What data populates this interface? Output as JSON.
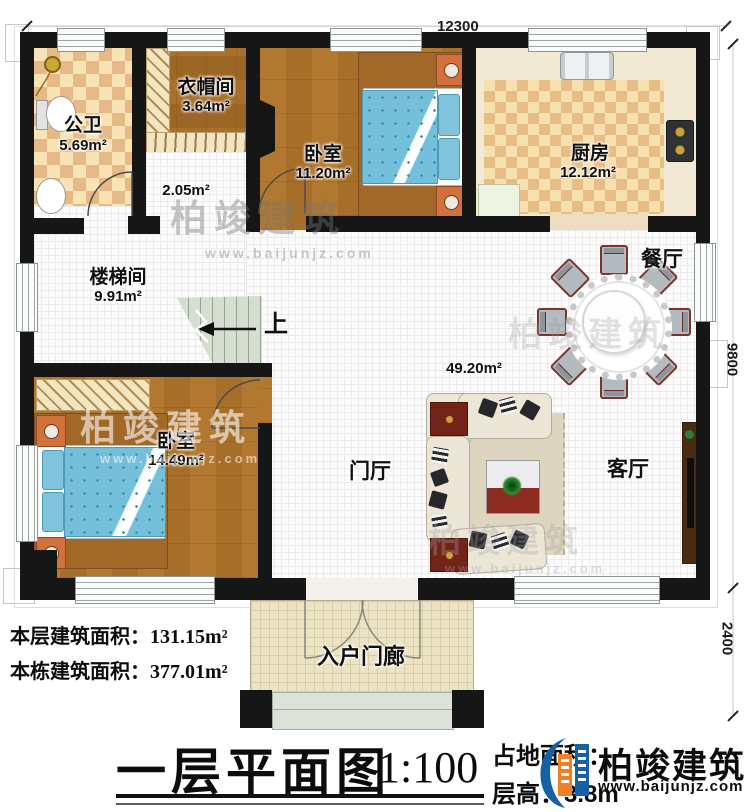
{
  "plan": {
    "dim_top": "12300",
    "dim_right": "9800",
    "dim_right_lower": "2400",
    "stairs_up": "上"
  },
  "rooms": {
    "toilet": {
      "name": "公卫",
      "area": "5.69m²"
    },
    "cloak": {
      "name": "衣帽间",
      "area": "3.64m²"
    },
    "bedroom1": {
      "name": "卧室",
      "area": "11.20m²"
    },
    "kitchen": {
      "name": "厨房",
      "area": "12.12m²"
    },
    "hallway": {
      "area": "2.05m²"
    },
    "stairhall": {
      "name": "楼梯间",
      "area": "9.91m²"
    },
    "bedroom2": {
      "name": "卧室",
      "area": "14.49m²"
    },
    "foyer": {
      "name": "门厅"
    },
    "dining": {
      "name": "餐厅"
    },
    "living": {
      "name": "客厅"
    },
    "great_room": {
      "area": "49.20m²"
    },
    "porch": {
      "name": "入户门廊"
    }
  },
  "footer": {
    "floor_area_label": "本层建筑面积：",
    "floor_area_value": "131.15m²",
    "building_area_label": "本栋建筑面积：",
    "building_area_value": "377.01m²",
    "title": "一层平面图",
    "scale": "1:100",
    "land_area_label": "占地面积：",
    "storey_height_label": "层高：",
    "storey_height_value": "3.8m"
  },
  "watermark": {
    "brand": "柏竣建筑",
    "site": "www.baijunjz.com"
  },
  "colors": {
    "wall": "#161616",
    "logo_blue": "#1660a8",
    "logo_orange": "#ef8026",
    "bed_blue": "#74c0da",
    "tile": "#f7e3b4"
  }
}
